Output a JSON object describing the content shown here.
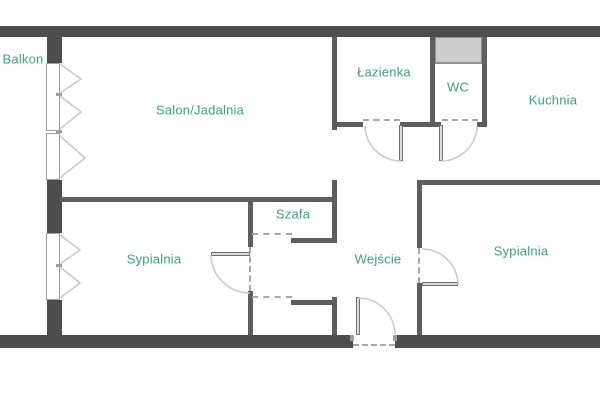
{
  "plan_title": "apartment-floor-plan",
  "colors": {
    "wall_exterior": "#4d4d4d",
    "wall_interior": "#5e5e5e",
    "label_text": "#3aa183",
    "shaft_fill": "#cccccc",
    "shaft_border": "#919191",
    "window_border": "#9e9e9e",
    "door_leaf": "#dcdcdc",
    "door_leaf_border": "#707070",
    "door_arc": "#c9c9c9",
    "dashed_line": "#a6a6a6"
  },
  "rooms": [
    {
      "id": "balkon",
      "label": "Balkon",
      "x": 23,
      "y": 59
    },
    {
      "id": "salon",
      "label": "Salon/Jadalnia",
      "x": 200,
      "y": 110
    },
    {
      "id": "lazienka",
      "label": "Łazienka",
      "x": 384,
      "y": 72
    },
    {
      "id": "wc",
      "label": "WC",
      "x": 458,
      "y": 87
    },
    {
      "id": "kuchnia",
      "label": "Kuchnia",
      "x": 553,
      "y": 100
    },
    {
      "id": "szafa",
      "label": "Szafa",
      "x": 293,
      "y": 214
    },
    {
      "id": "sypialnia-1",
      "label": "Sypialnia",
      "x": 154,
      "y": 259
    },
    {
      "id": "wejscie",
      "label": "Wejście",
      "x": 378,
      "y": 259
    },
    {
      "id": "sypialnia-2",
      "label": "Sypialnia",
      "x": 521,
      "y": 251
    }
  ]
}
